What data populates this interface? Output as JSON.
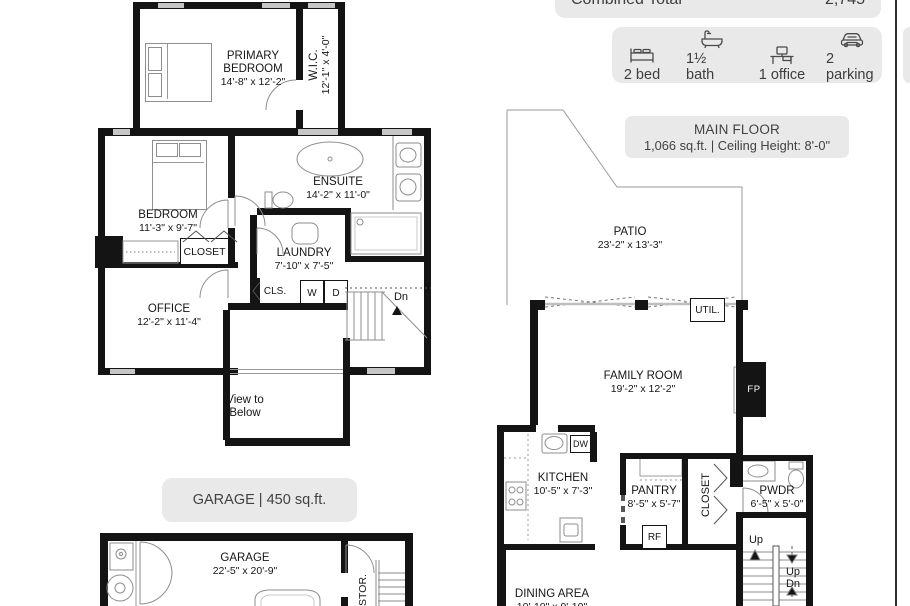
{
  "header": {
    "combined_total_label": "Combined Total",
    "combined_total_value": "2,745"
  },
  "features": {
    "bed": "2 bed",
    "bath": "1½ bath",
    "office": "1 office",
    "parking": "2 parking"
  },
  "main_floor_box": {
    "title": "MAIN FLOOR",
    "details": "1,066 sq.ft. | Ceiling Height: 8'-0\""
  },
  "garage_box": {
    "label": "GARAGE | 450 sq.ft."
  },
  "upper": {
    "primary": {
      "l1": "PRIMARY",
      "l2": "BEDROOM",
      "dim": "14'-8\" x 12'-2\""
    },
    "wic": {
      "name": "W.I.C.",
      "dim": "12'-1\" x 4'-0\""
    },
    "bedroom": {
      "name": "BEDROOM",
      "dim": "11'-3\" x 9'-7\""
    },
    "ensuite": {
      "name": "ENSUITE",
      "dim": "14'-2\" x 11'-0\""
    },
    "laundry": {
      "name": "LAUNDRY",
      "dim": "7'-10\" x 7'-5\""
    },
    "closet": "CLOSET",
    "cls": "CLS.",
    "washer": "W",
    "dryer": "D",
    "office": {
      "name": "OFFICE",
      "dim": "12'-2\" x 11'-4\""
    },
    "dn": "Dn",
    "view1": "View to",
    "view2": "Below"
  },
  "main": {
    "patio": {
      "name": "PATIO",
      "dim": "23'-2\" x 13'-3\""
    },
    "util": "UTIL.",
    "family": {
      "name": "FAMILY ROOM",
      "dim": "19'-2\" x 12'-2\""
    },
    "fp": "FP",
    "kitchen": {
      "name": "KITCHEN",
      "dim": "10'-5\" x 7'-3\""
    },
    "dw": "DW",
    "pantry": {
      "name": "PANTRY",
      "dim": "8'-5\" x 5'-7\""
    },
    "rf": "RF",
    "closet": "CLOSET",
    "pwdr": {
      "name": "PWDR",
      "dim": "6'-5\" x 5'-0\""
    },
    "up_left": "Up",
    "up_right": "Up",
    "dn_right": "Dn",
    "dining": {
      "name": "DINING AREA",
      "dim": "10'-10\" x 9'-10\""
    }
  },
  "garage": {
    "name": "GARAGE",
    "dim": "22'-5\" x 20'-9\"",
    "stor": "STOR."
  },
  "colors": {
    "card_gray": "#e9e9e9",
    "wall_black": "#141414",
    "window_gray": "#c6c6c6"
  }
}
